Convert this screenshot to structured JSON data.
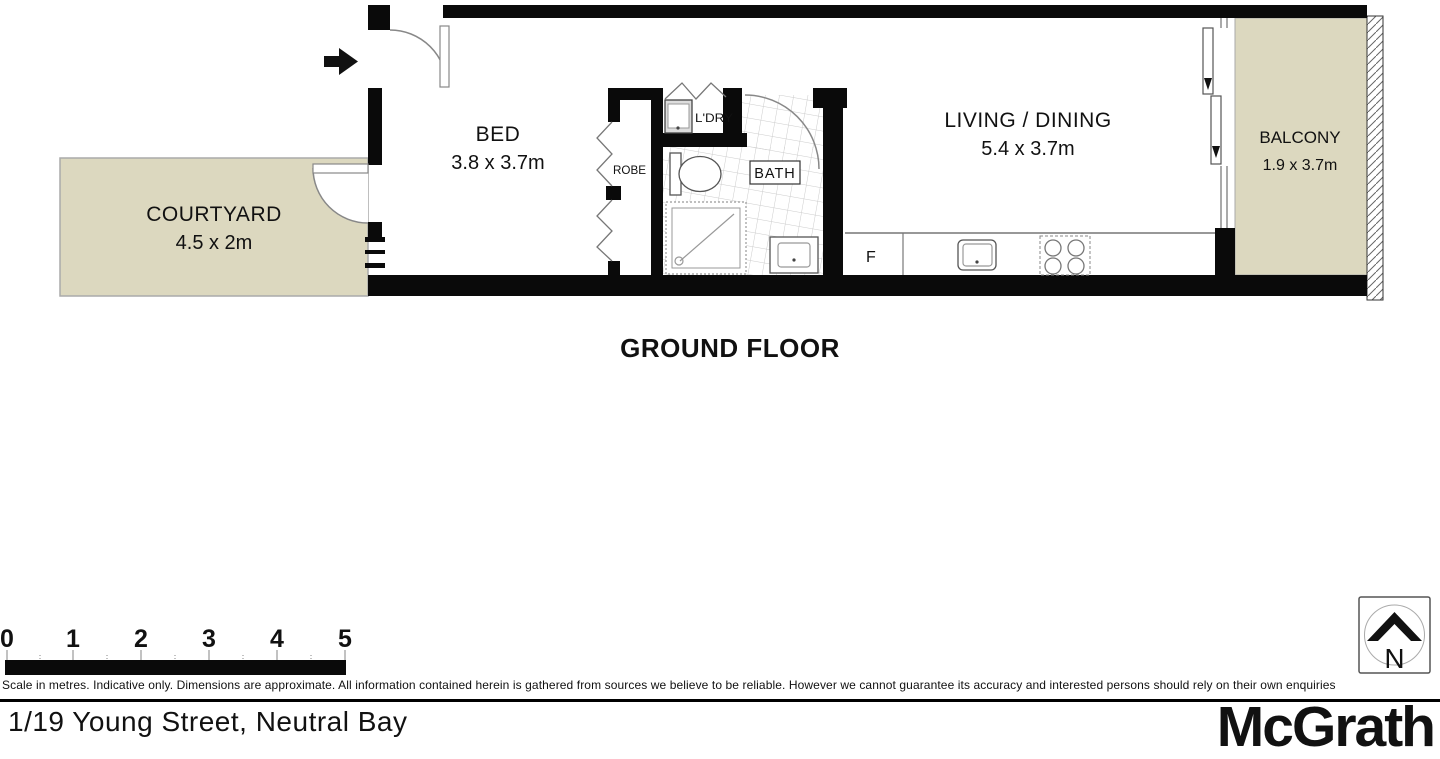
{
  "floorplan": {
    "level_label": "GROUND FLOOR",
    "rooms": [
      {
        "name": "COURTYARD",
        "dims": "4.5 x 2m"
      },
      {
        "name": "BED",
        "dims": "3.8 x 3.7m"
      },
      {
        "name": "ROBE",
        "dims": ""
      },
      {
        "name": "L'DRY",
        "dims": ""
      },
      {
        "name": "BATH",
        "dims": ""
      },
      {
        "name": "LIVING / DINING",
        "dims": "5.4 x 3.7m"
      },
      {
        "name": "BALCONY",
        "dims": "1.9 x 3.7m"
      }
    ],
    "labels": {
      "fridge": "F"
    },
    "colors": {
      "wall": "#0a0a0a",
      "outdoor_fill": "#dcd8bf",
      "tile_line": "#cccccc",
      "outline_gray": "#888888"
    }
  },
  "scale_bar": {
    "ticks": [
      "0",
      "1",
      "2",
      "3",
      "4",
      "5"
    ]
  },
  "compass": {
    "north": "N"
  },
  "disclaimer": "Scale in metres. Indicative only. Dimensions are approximate. All information contained herein is gathered from sources we believe to be reliable. However we cannot guarantee its accuracy and interested persons should rely on their own enquiries",
  "footer": {
    "address": "1/19 Young Street, Neutral Bay",
    "brand": "McGrath"
  }
}
